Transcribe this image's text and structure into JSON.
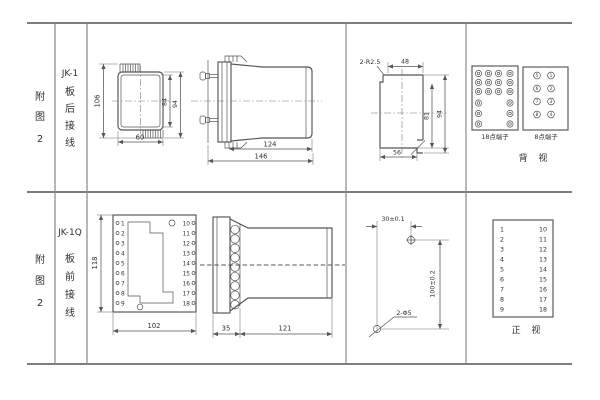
{
  "colors": {
    "background": "#ffffff",
    "line": "#555555",
    "table_line": "#7d7d7d",
    "text": "#303030"
  },
  "figure1": {
    "figure_label": [
      "附",
      "图",
      "2"
    ],
    "model": "JK-1",
    "wiring": [
      "板",
      "后",
      "接",
      "线"
    ],
    "rear_view_dims": {
      "total_height": "106",
      "inner_height": "84",
      "outer_height": "94",
      "width": "60"
    },
    "side_view_dims": {
      "case_length": "124",
      "total_length": "146"
    },
    "cutout": {
      "corner_note": "2-R2.5",
      "top_width": "48",
      "inner_height": "81",
      "height": "94",
      "bottom_width": "56"
    },
    "terminals18": {
      "label": "18点端子",
      "rows": [
        4,
        4,
        4,
        2,
        2,
        2
      ]
    },
    "terminals8": {
      "label": "8点端子",
      "rows": [
        [
          "5",
          "1"
        ],
        [
          "6",
          "2"
        ],
        [
          "7",
          "3"
        ],
        [
          "8",
          "4"
        ]
      ]
    },
    "view_label": "背 视"
  },
  "figure2": {
    "figure_label": [
      "附",
      "图",
      "2"
    ],
    "model": "JK-1Q",
    "wiring": [
      "板",
      "前",
      "接",
      "线"
    ],
    "front_view": {
      "left_terminals": [
        "1",
        "2",
        "3",
        "4",
        "5",
        "6",
        "7",
        "8",
        "9"
      ],
      "right_terminals": [
        "10",
        "11",
        "12",
        "13",
        "14",
        "15",
        "16",
        "17",
        "18"
      ],
      "height": "118",
      "width": "102"
    },
    "side_view_dims": {
      "flange": "35",
      "case_length": "121"
    },
    "drill": {
      "h_spacing": "30±0.1",
      "v_spacing": "100±0.2",
      "holes": "2-Φ5"
    },
    "view_label": "正 视"
  }
}
